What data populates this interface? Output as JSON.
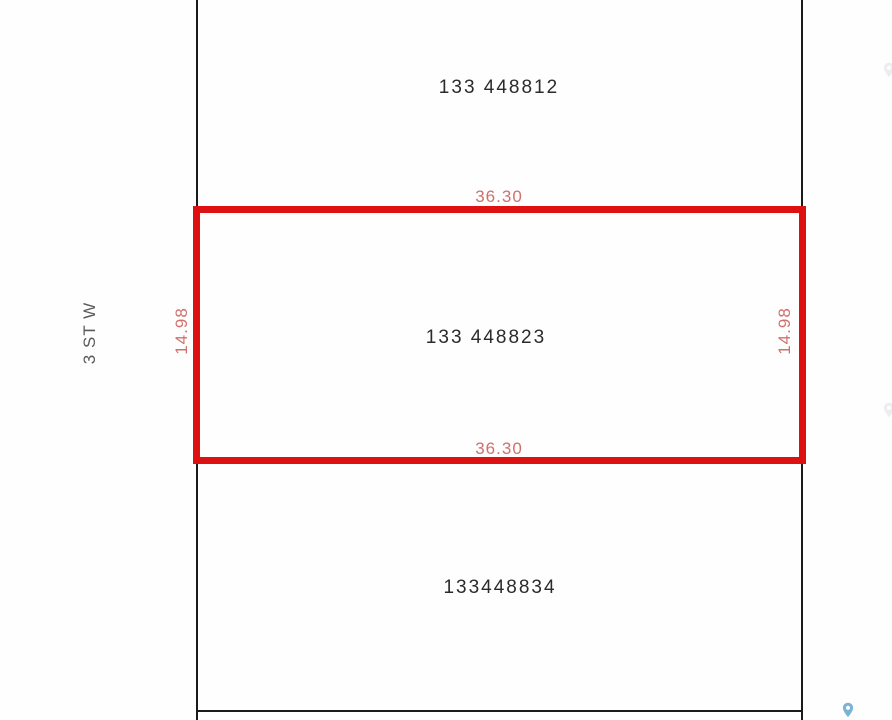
{
  "street": {
    "label": "3 ST W"
  },
  "parcels": {
    "top": {
      "id_label": "133 448812"
    },
    "selected": {
      "id_label": "133 448823",
      "dim_width_top": "36.30",
      "dim_width_bottom": "36.30",
      "dim_height_left": "14.98",
      "dim_height_right": "14.98"
    },
    "bottom": {
      "id_label": "133448834"
    }
  },
  "colors": {
    "selection_outline": "#dd1111",
    "dimension_text": "#d0706c",
    "parcel_boundary": "#1b1b1b",
    "parcel_text": "#2b2b2b",
    "street_text": "#5a5a5a",
    "pin": "#7ab3d6"
  },
  "icons": {
    "pin": "map-pin"
  }
}
